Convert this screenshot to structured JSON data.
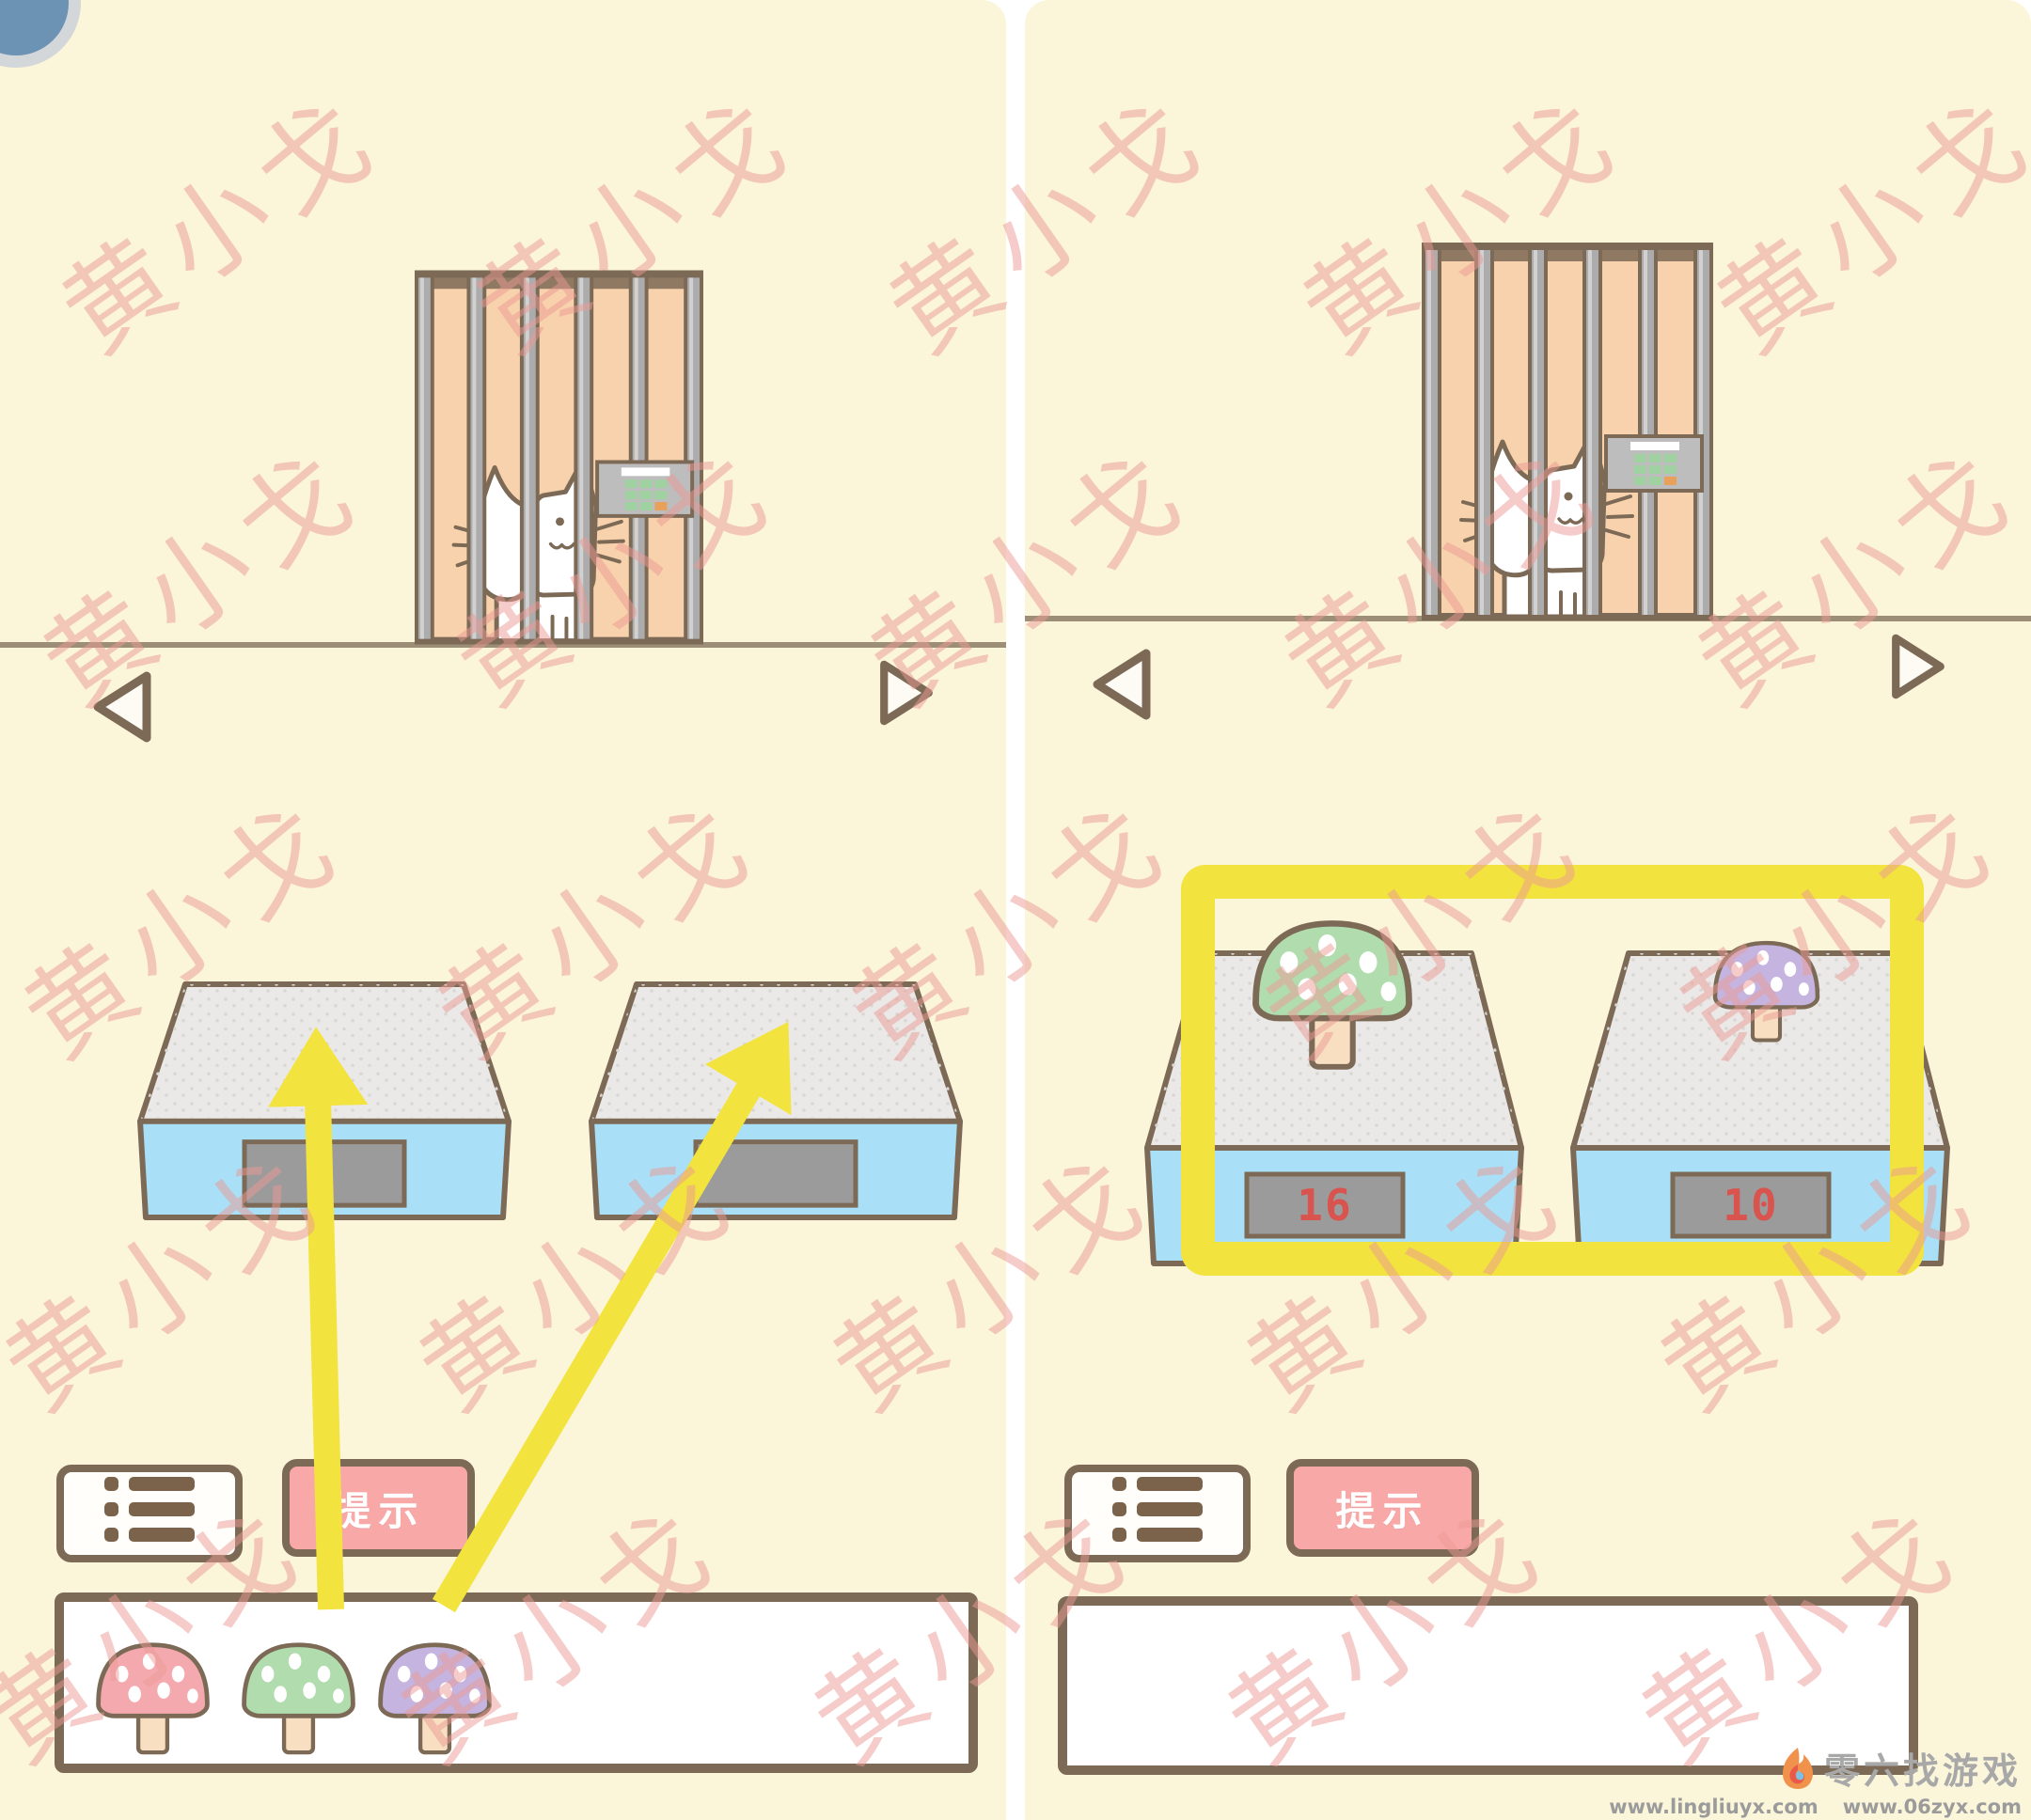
{
  "watermark": {
    "text": "黄小戈"
  },
  "colors": {
    "bg": "#FBF5DA",
    "outline": "#7C6A56",
    "peach": "#F8D2AC",
    "bar_gray": "#ACACAC",
    "floor": "#9C8E77",
    "scale_top": "#EAE9E7",
    "scale_blue": "#A9DFF7",
    "display_gray": "#9B9B9B",
    "display_red": "#D9534F",
    "yellow": "#F2E33F",
    "pink_button": "#F9A8A8",
    "mush_pink": "#F4A9AE",
    "mush_green": "#B0DCAE",
    "mush_purple": "#C4B4DF",
    "stem": "#F8DFC2",
    "keypad_gray": "#BDBDBD",
    "keypad_green": "#9FD2A0",
    "keypad_orange": "#E8A05A",
    "watermark_pink": "rgba(236,153,148,0.5)",
    "logo_gray": "#A8A8A8",
    "url_gray": "#9B9B9B"
  },
  "icons": {
    "list_button": "list-icon",
    "nav_previous": "triangle-left-icon",
    "nav_next": "triangle-right-icon",
    "footer": "flame-icon",
    "lock": "keypad-lock-icon"
  },
  "left_panel": {
    "hint_button_label": "提示",
    "scales": [
      {
        "display": ""
      },
      {
        "display": ""
      }
    ],
    "inventory": [
      "pink-mushroom",
      "green-mushroom",
      "purple-mushroom"
    ]
  },
  "right_panel": {
    "hint_button_label": "提示",
    "scales": [
      {
        "display": "16"
      },
      {
        "display": "10"
      }
    ]
  },
  "footer": {
    "brand": "零六找游戏",
    "urls": [
      "www.lingliuyx.com",
      "www.06zyx.com"
    ]
  }
}
